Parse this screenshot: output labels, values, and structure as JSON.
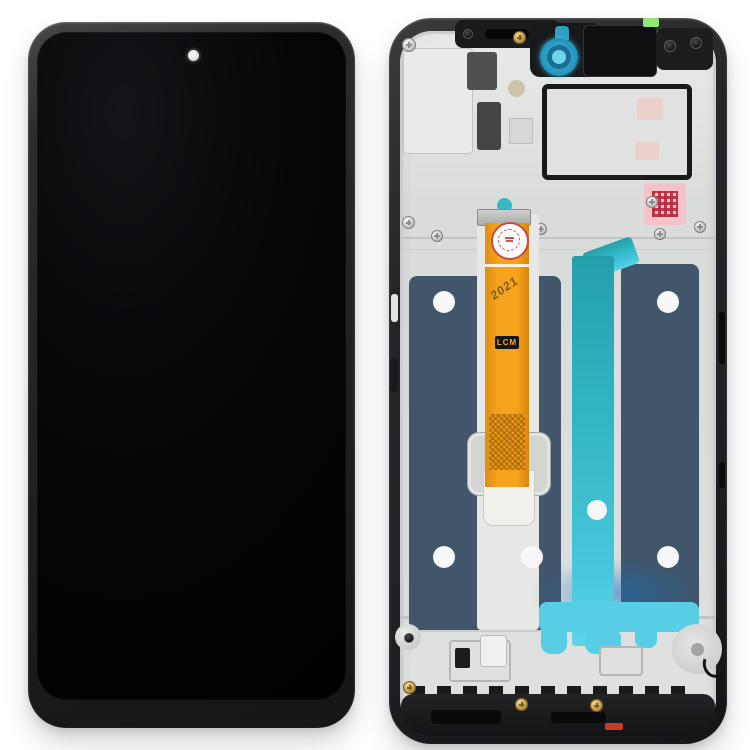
{
  "scene": {
    "description": "Product photo: phone LCD screen digitizer full assembly with frame, front view (left) and rear frame view (right)",
    "background_color": "#ffffff"
  },
  "front_unit": {
    "part": "lcd-front-assembly",
    "screen_color": "#000000",
    "camera": "punch-hole-front-camera"
  },
  "rear_unit": {
    "part": "middle-frame-rear-view",
    "flex_label": "LCM",
    "date_stamp": "2021"
  },
  "colors": {
    "navy": "#41566a",
    "teal": "#2fb3c0",
    "teal-light": "#58cde6",
    "orange": "#f6a41d",
    "pink": "#f4c3ca",
    "gold": "#c49b47",
    "green": "#98e470",
    "red": "#c23a30",
    "silver": "#dcdedd",
    "frameblack": "#222226",
    "camcyan": "#3fc0df"
  }
}
